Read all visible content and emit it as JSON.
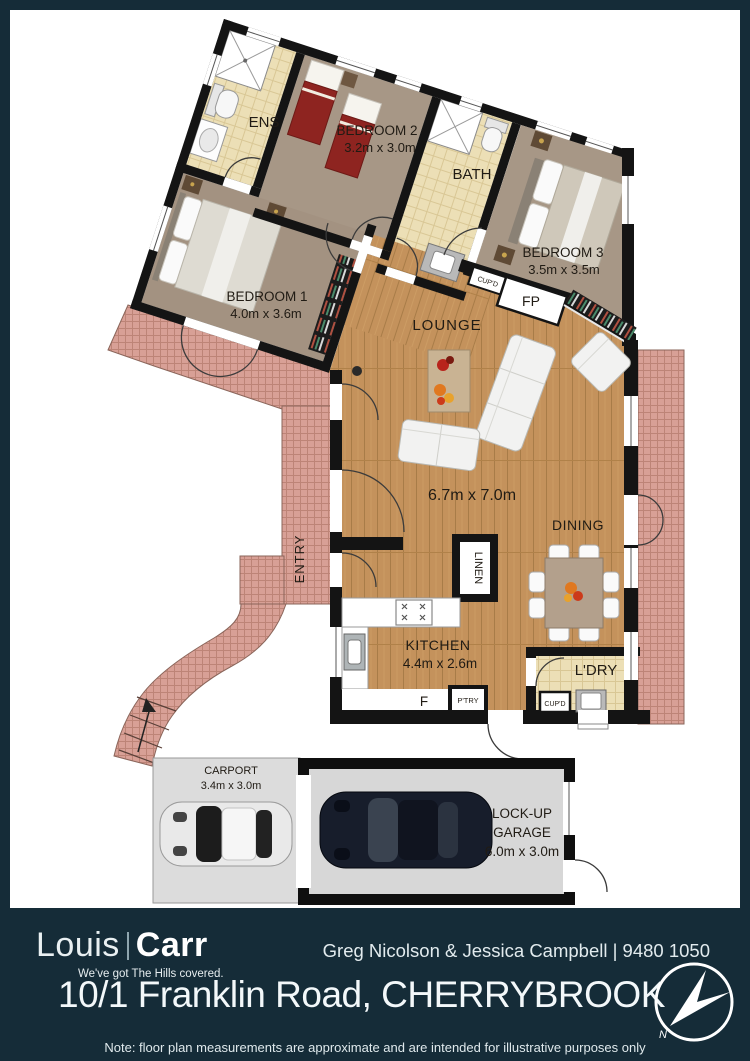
{
  "colors": {
    "background_teal": "#152c38",
    "paper": "#ffffff",
    "wall": "#141414",
    "wood_floor": "#c4925c",
    "carpet": "#a79786",
    "tile_cream": "#ecdfb6",
    "brick_pink": "#d8a096",
    "slab_grey": "#dcdcdc"
  },
  "plan": {
    "rooms": {
      "bedroom1": {
        "name": "BEDROOM 1",
        "dims": "4.0m x 3.6m"
      },
      "bedroom2": {
        "name": "BEDROOM 2",
        "dims": "3.2m x 3.0m"
      },
      "bedroom3": {
        "name": "BEDROOM 3",
        "dims": "3.5m x 3.5m"
      },
      "ensuite": {
        "name": "ENS"
      },
      "bath": {
        "name": "BATH"
      },
      "lounge": {
        "name": "LOUNGE",
        "dims": "6.7m x 7.0m"
      },
      "dining": {
        "name": "DINING"
      },
      "kitchen": {
        "name": "KITCHEN",
        "dims": "4.4m x 2.6m"
      },
      "laundry": {
        "name": "L'DRY"
      },
      "entry": {
        "name": "ENTRY"
      },
      "carport": {
        "name": "CARPORT",
        "dims": "3.4m x 3.0m"
      },
      "garage": {
        "line1": "LOCK-UP",
        "line2": "GARAGE",
        "dims": "6.0m x 3.0m"
      }
    },
    "fixtures": {
      "linen": "LINEN",
      "cupboard_hall": "CUP'D",
      "cupboard_laundry": "CUP'D",
      "fireplace": "FP",
      "fridge": "F",
      "pantry": "P'TRY"
    },
    "compass_north": "N"
  },
  "footer": {
    "brand": {
      "name_light": "Louis",
      "name_bold": "Carr",
      "tagline": "We've got The Hills covered."
    },
    "agents": "Greg Nicolson & Jessica Campbell | 9480 1050",
    "address": "10/1 Franklin Road, CHERRYBROOK",
    "note": "Note: floor plan measurements are approximate and are intended for illustrative purposes only"
  }
}
